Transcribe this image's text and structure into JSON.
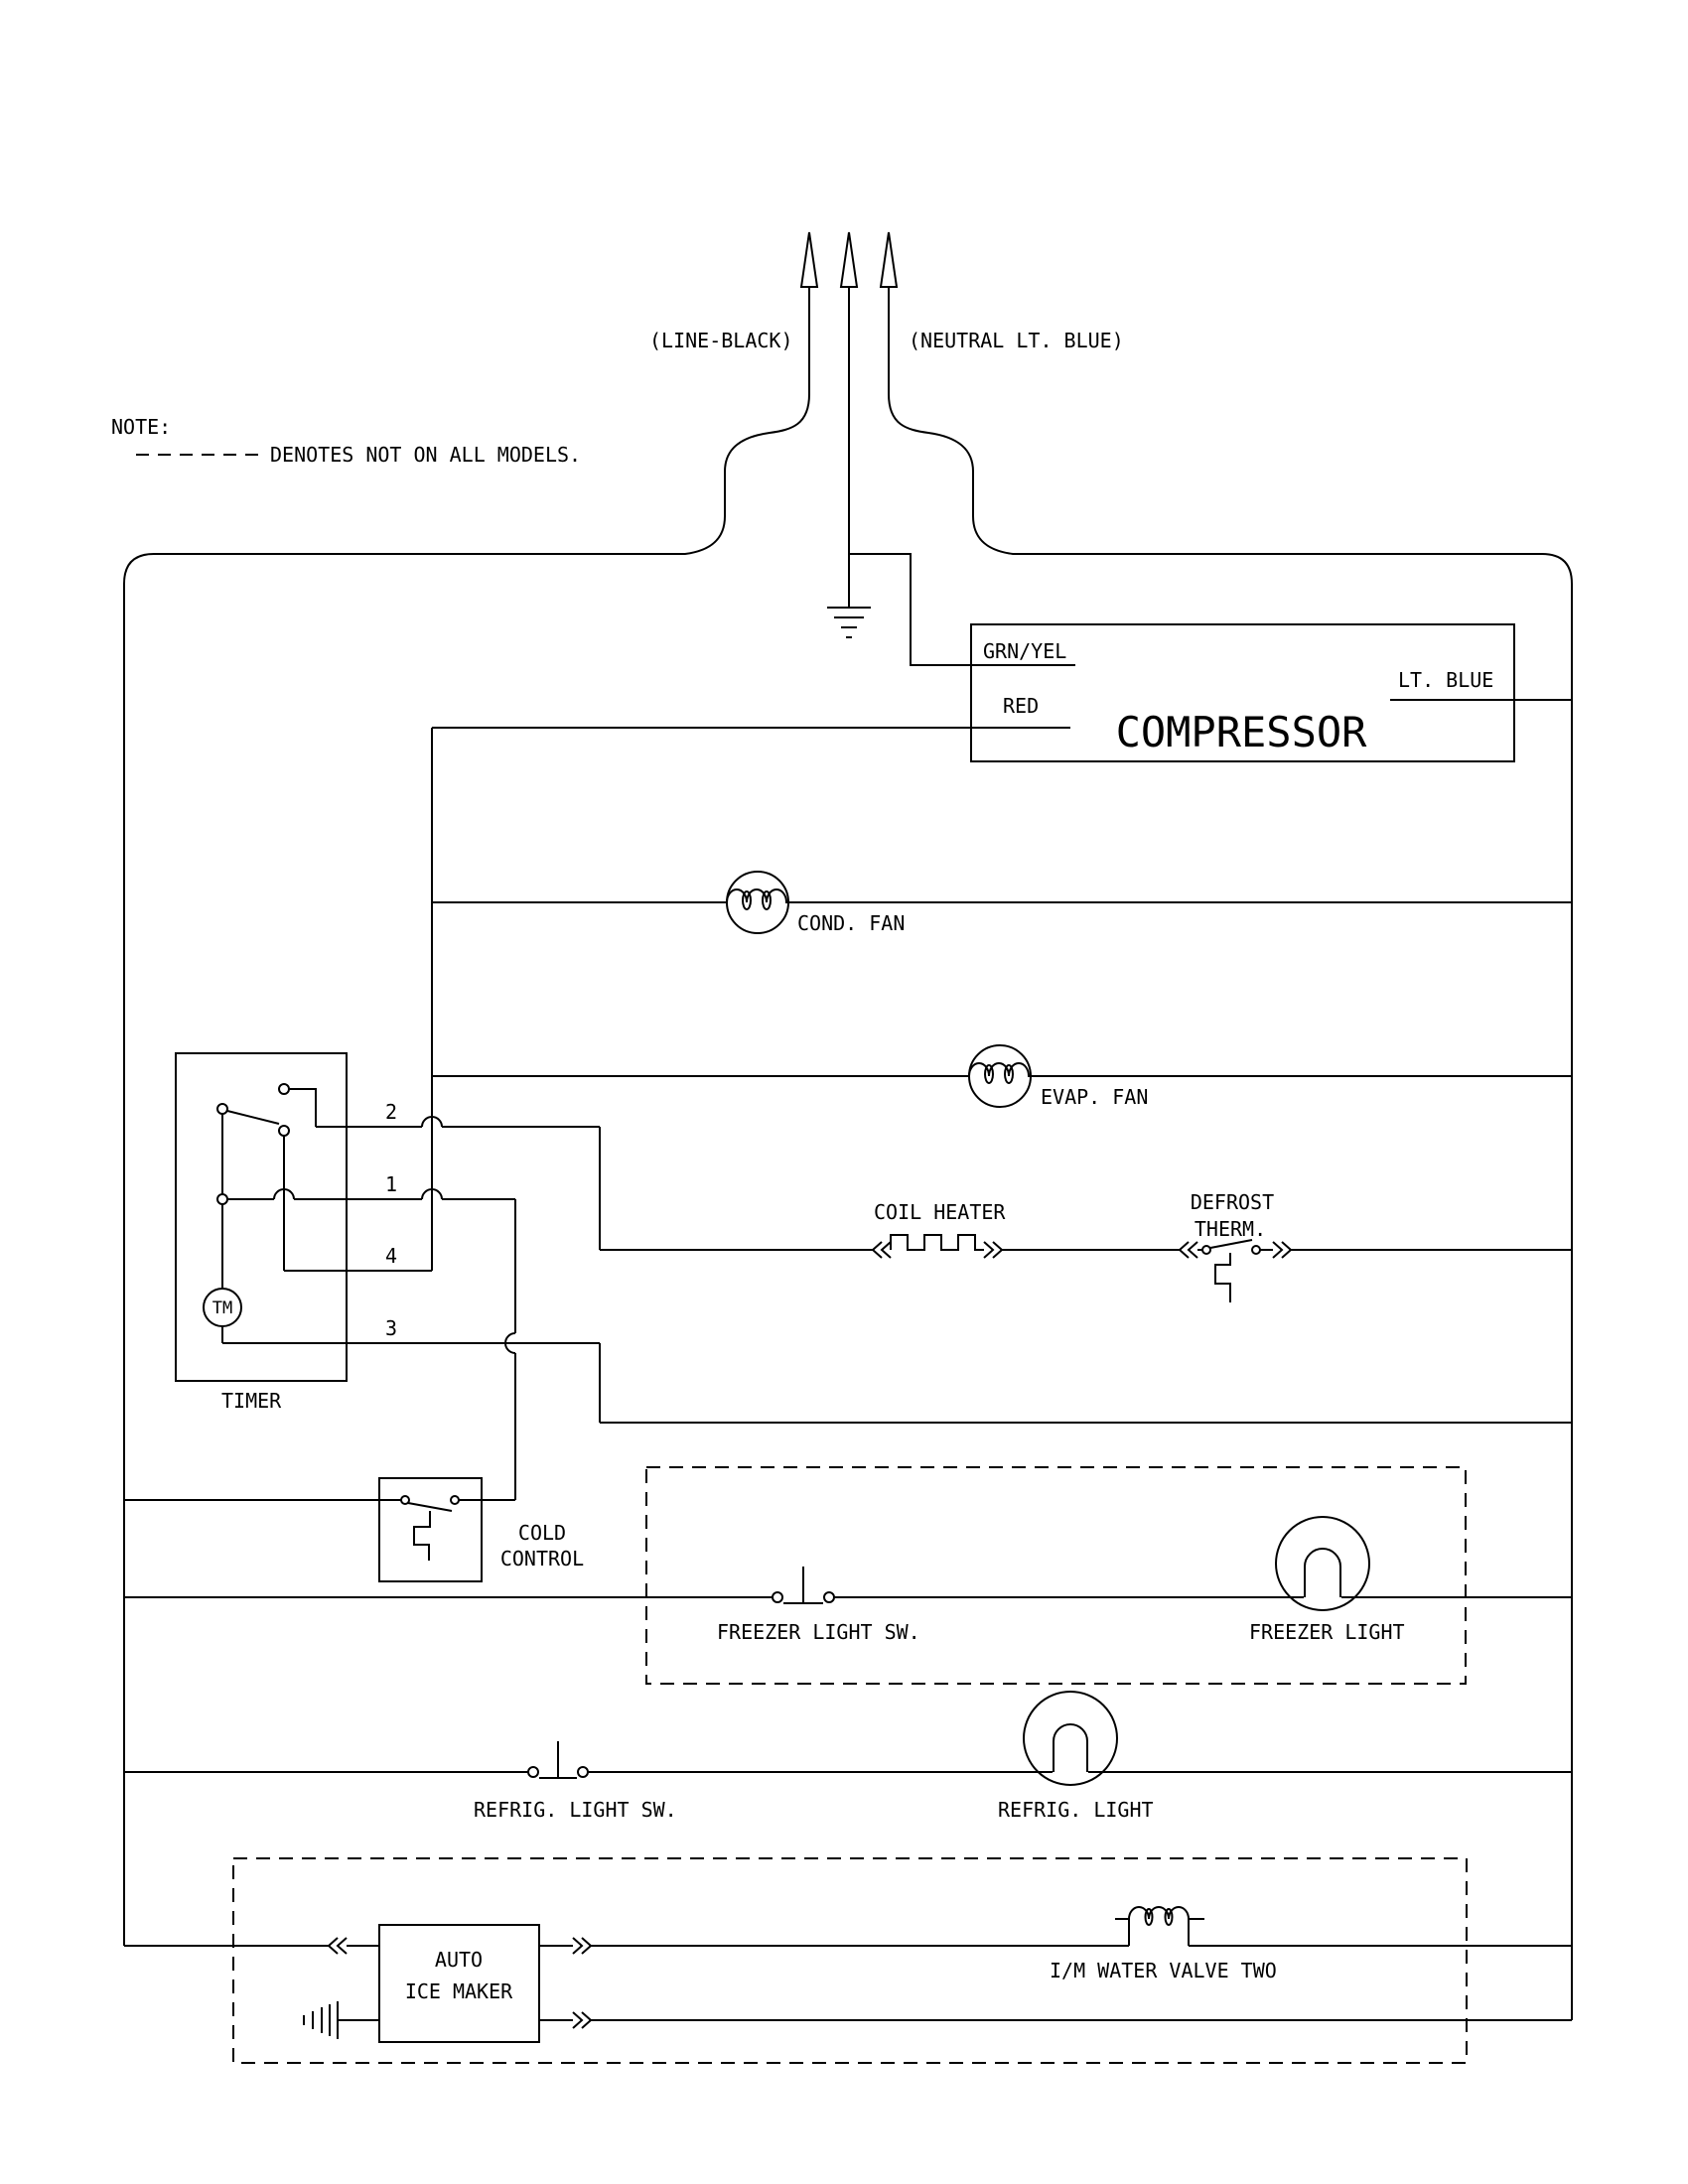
{
  "diagram": {
    "note": {
      "label": "NOTE:",
      "text": "DENOTES NOT ON ALL MODELS."
    },
    "terminals": {
      "line": "(LINE-BLACK)",
      "neutral": "(NEUTRAL LT. BLUE)"
    },
    "compressor": {
      "label": "COMPRESSOR",
      "grn_yel": "GRN/YEL",
      "red": "RED",
      "lt_blue": "LT. BLUE"
    },
    "fans": {
      "cond": "COND. FAN",
      "evap": "EVAP. FAN"
    },
    "heater": {
      "label": "COIL HEATER"
    },
    "defrost": {
      "line1": "DEFROST",
      "line2": "THERM."
    },
    "timer": {
      "label": "TIMER",
      "motor": "TM",
      "contacts": [
        "2",
        "1",
        "4",
        "3"
      ]
    },
    "cold_control": {
      "line1": "COLD",
      "line2": "CONTROL"
    },
    "freezer": {
      "sw": "FREEZER LIGHT SW.",
      "light": "FREEZER LIGHT"
    },
    "refrig": {
      "sw": "REFRIG. LIGHT SW.",
      "light": "REFRIG. LIGHT"
    },
    "ice_maker": {
      "line1": "AUTO",
      "line2": "ICE MAKER",
      "valve": "I/M WATER VALVE TWO"
    },
    "colors": {
      "line": "#000000",
      "background": "#ffffff"
    }
  }
}
